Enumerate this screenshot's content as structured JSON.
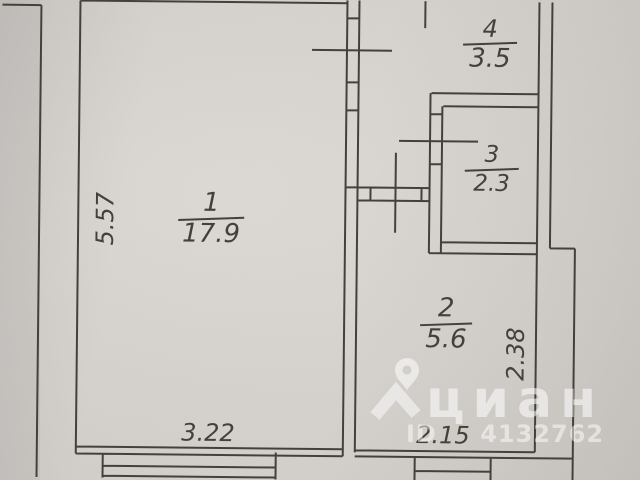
{
  "floorplan": {
    "rooms": [
      {
        "number": "1",
        "area": "17.9"
      },
      {
        "number": "2",
        "area": "5.6"
      },
      {
        "number": "3",
        "area": "2.3"
      },
      {
        "number": "4",
        "area": "3.5"
      }
    ],
    "dimensions": {
      "room1_height": "5.57",
      "room1_width": "3.22",
      "room2_width": "2.15",
      "room2_height": "2.38"
    }
  },
  "watermark": {
    "logo_icon": "map-pin-icon",
    "brand_text": "циан",
    "listing_id": "ID 4132762",
    "color": "#ffffff"
  },
  "colors": {
    "paper": "#d6d2cd",
    "ink": "#45403a"
  }
}
